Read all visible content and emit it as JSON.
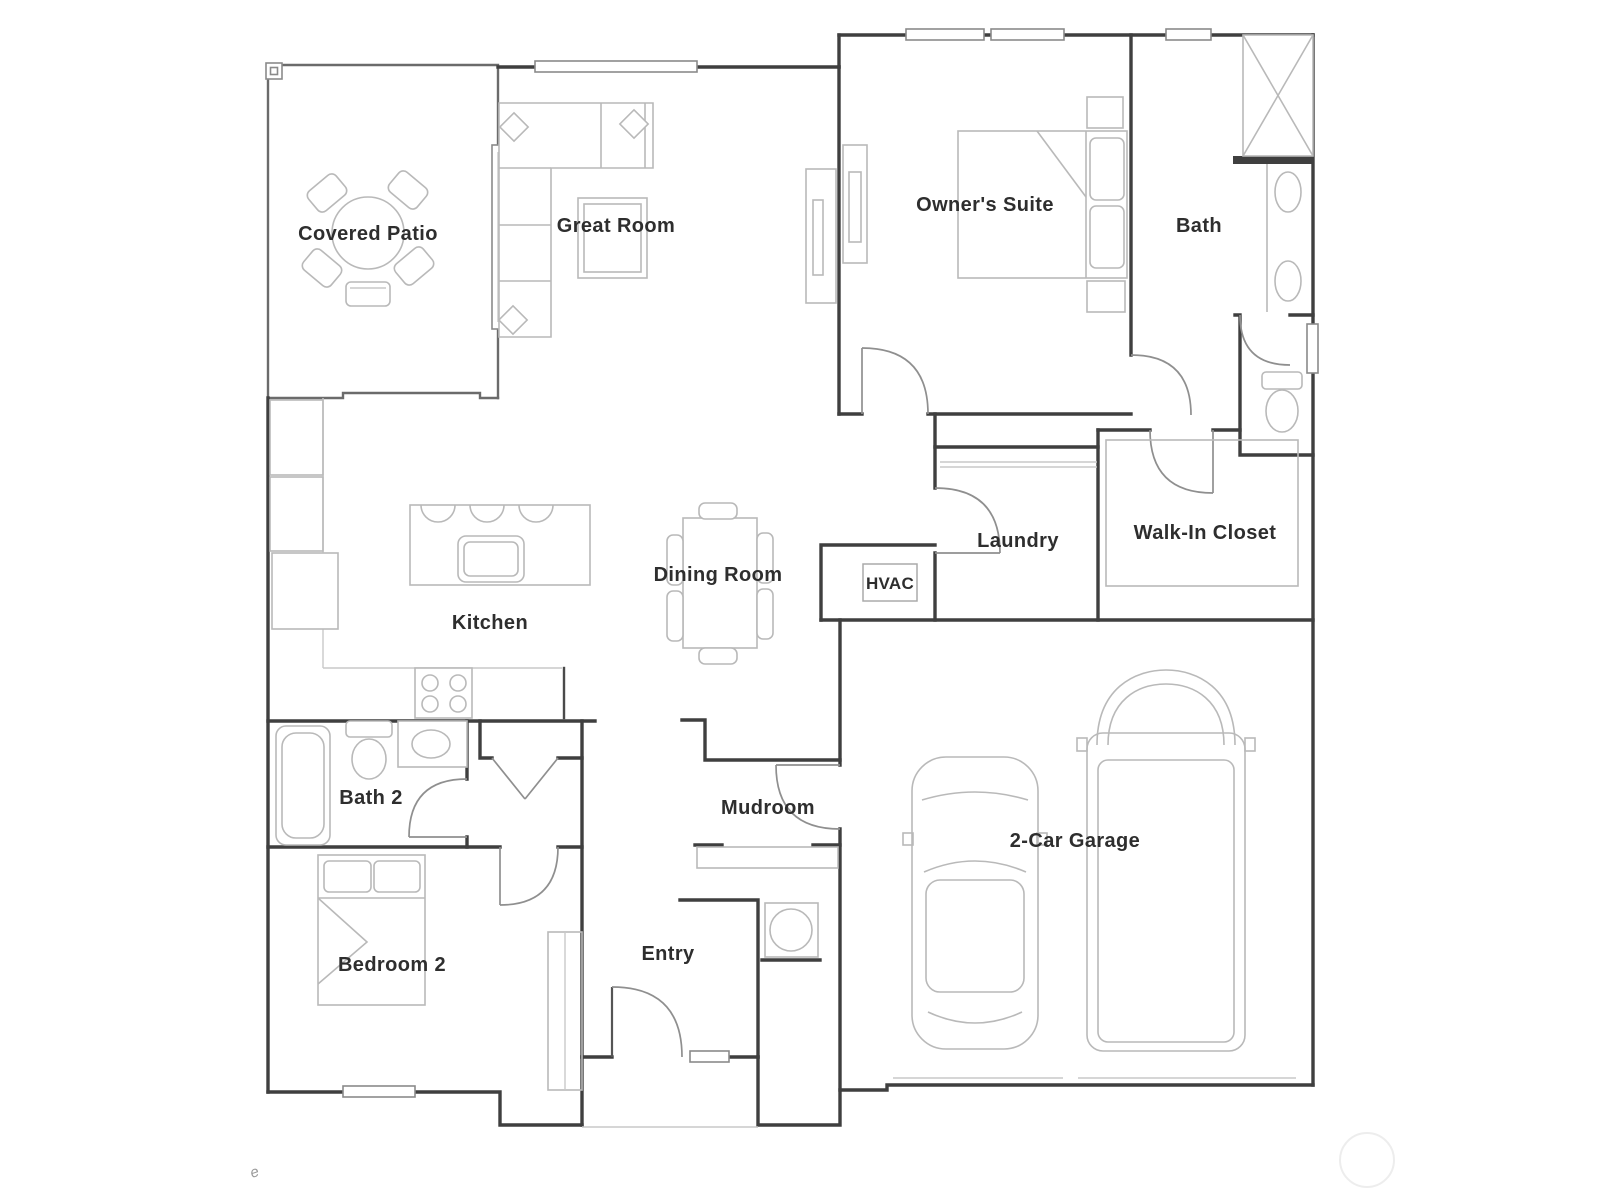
{
  "rooms": {
    "covered_patio": {
      "label": "Covered Patio"
    },
    "great_room": {
      "label": "Great Room"
    },
    "owners_suite": {
      "label": "Owner's Suite"
    },
    "bath": {
      "label": "Bath"
    },
    "kitchen": {
      "label": "Kitchen"
    },
    "dining_room": {
      "label": "Dining Room"
    },
    "hvac": {
      "label": "HVAC"
    },
    "laundry": {
      "label": "Laundry"
    },
    "walk_in_closet": {
      "label": "Walk-In Closet"
    },
    "bath_2": {
      "label": "Bath 2"
    },
    "mudroom": {
      "label": "Mudroom"
    },
    "bedroom_2": {
      "label": "Bedroom 2"
    },
    "entry": {
      "label": "Entry"
    },
    "garage": {
      "label": "2-Car Garage"
    }
  },
  "watermark": {
    "glyph": "e"
  },
  "colors": {
    "wall": "#3f3f3f",
    "patio_wall": "#6b6b6b",
    "furniture": "#b9b9b9",
    "door_swing": "#8f8f8f",
    "window": "#8a8a8a",
    "label_text": "#2e2e2e",
    "background": "#ffffff"
  }
}
